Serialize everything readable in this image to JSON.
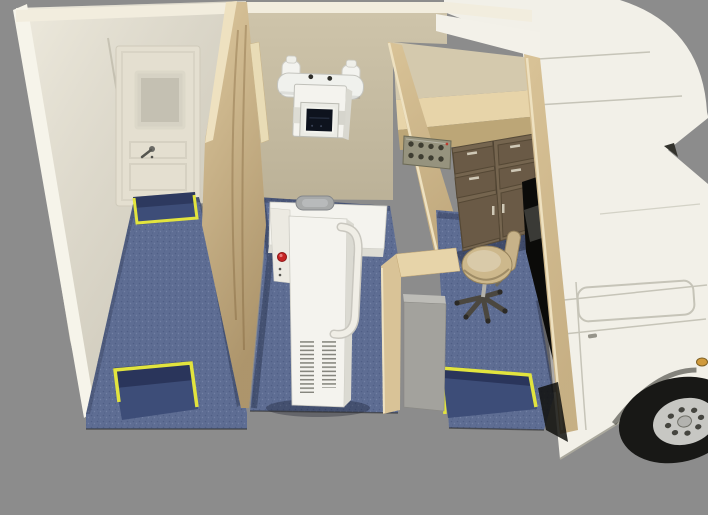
{
  "scene": {
    "type": "3d-render-cutaway-top-view",
    "subject": "mobile-xray-clinic-truck-interior",
    "rooms": [
      "entry-room",
      "xray-room",
      "control-room"
    ],
    "objects": [
      "entry-door",
      "door-step-well",
      "front-left-step-well",
      "control-room-step-well",
      "wall-mounted-xray-tube",
      "collimator",
      "xray-patient-unit",
      "emergency-stop-button",
      "wood-partition-wall",
      "control-panel",
      "overhead-counter",
      "drawer-cabinet",
      "work-counter",
      "equipment-box",
      "swivel-stool",
      "cab-passage-opening",
      "truck-cab",
      "cab-door",
      "front-wheel",
      "side-marker-light"
    ]
  },
  "colors": {
    "bg": "#8c8c8c",
    "wall_top": "#f2edde",
    "wall_cream": "#e8e3d4",
    "beam_white": "#f6f4ea",
    "door_face": "#e4dfd0",
    "door_window": "#c4c0b2",
    "wall_beige": "#cfc5ab",
    "band_white": "#f3f1e9",
    "band_beige": "#d4c9ad",
    "counter_wood": "#e7d4a9",
    "under_counter": "#bca677",
    "wood_light": "#dcc79d",
    "wood_edge": "#eee1c0",
    "wood_wall": "#d9c397",
    "cabinet_face": "#75654f",
    "cabinet_panel": "#6a5a46",
    "handle_light": "#cfc8b6",
    "floor_blue": "#5e6d93",
    "well_blue": "#3d4d78",
    "safety_yellow": "#e2e43e",
    "machine_white": "#f4f3ee",
    "handle_gray": "#a7a9a9",
    "red_button": "#c62424",
    "tube_white": "#f0f1ed",
    "collimator_dark": "#0e131e",
    "panel_gray": "#96937e",
    "knob_dark": "#3e3d31",
    "box_gray": "#a3a29d",
    "black_opening": "#0b0b09",
    "stool_seat": "#cdb88c",
    "stool_base": "#4b473f",
    "truck_white": "#f2f0e8",
    "truck_line": "#c6c4b8",
    "tire_black": "#181816",
    "hub_gray": "#c7c7c3",
    "lug_dark": "#45453f",
    "amber": "#d09a3c"
  }
}
